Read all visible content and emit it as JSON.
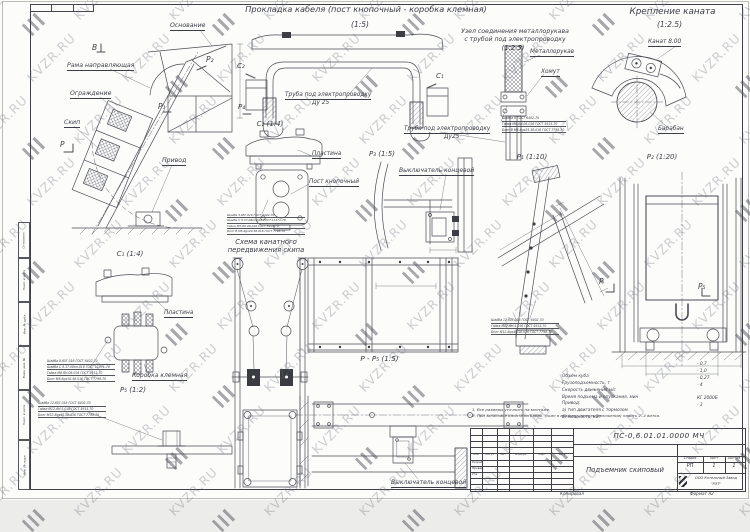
{
  "watermark": {
    "text": "KVZR.RU"
  },
  "sheet": {
    "copied": "Копировал",
    "format": "Формат А2"
  },
  "side_stamp": {
    "approved": "Согласовано",
    "boxes": [
      "Подп. и дата",
      "Инв. № дубл.",
      "Взам. инв. №",
      "Подп. и дата",
      "Инв. № подл."
    ]
  },
  "titles": {
    "cable": {
      "text": "Прокладка кабеля (пост кнопочный - коробка клемная)",
      "scale": "(1:5)"
    },
    "hose": {
      "line1": "Узел соединения металлорукава",
      "line2": "с трубой под электропроводку",
      "scale": "(1:2.5)"
    },
    "rope": {
      "text": "Крепление каната",
      "scale": "(1:2.5)"
    },
    "scheme": {
      "line1": "Схема канатного",
      "line2": "передвижения скипа"
    }
  },
  "views": {
    "c1": "С₁ (1:4)",
    "c2": "С₂ (1:4)",
    "p1": "Р₁ (1:10)",
    "p2": "Р₂ (1:20)",
    "p3": "Р₃ (1:5)",
    "p5": "Р₅ (1:2)",
    "pp5": "Р - Р₅ (1:5)"
  },
  "marks": {
    "b": "В",
    "p": "Р",
    "p1": "Р₁",
    "p2": "Р₂",
    "p4": "Р₄",
    "p5": "Р₅",
    "c1": "С₁",
    "c2": "С₂"
  },
  "labels": {
    "osnovanie": "Основание",
    "rama": "Рама направляющая",
    "ograzhdenie": "Ограждение",
    "skip": "Скип",
    "privod": "Привод",
    "truba1": "Труба под электропроводку",
    "du25_1": "Ду 25",
    "truba2": "Труба под электропроводку",
    "du25_2": "Ду25",
    "metallorukav": "Металлорукав",
    "khomut": "Хомут",
    "kanat": "Канат 8.00",
    "baraban": "Барабан",
    "plastina1": "Пластина",
    "post": "Пост кнопочный",
    "vykl1": "Выключатель концевой",
    "plastina2": "Пластина",
    "korobka": "Коробка клемная",
    "vykl2": "Выключатель концевой"
  },
  "parts": {
    "hose": [
      "Шайба 6 ГОСТ 6402-70",
      "Гайка М6-6Н.06.016 ГОСТ 5915-70",
      "Болт В М6-6gх25.58.016 ГОСТ 7798-70"
    ],
    "c2": [
      "Шайба 5.65Г.016 ГОСТ 6402-70",
      "Шайба С 5.37.08кп.016 ГОСТ 11371-78",
      "Гайка М5-6Н.06.016 ГОСТ 5915-70",
      "Болт В М5-6gх20.58.016 ГОСТ 7798-70"
    ],
    "c1": [
      "Шайба 8.65Г.016 ГОСТ 6402-70",
      "Шайба С 8.37.08кп.016 ГОСТ 11371-78",
      "Гайка М8-6Н.06.016 ГОСТ 5915-70",
      "Болт М8-6gх10.58.016 ГОСТ 7798-70"
    ],
    "p1": [
      "Шайба 12.65Г.016 ГОСТ 6402-70",
      "Гайка М12-6Н.5.016 ГОСТ 5915-70",
      "Болт М12-6gх45.58.016 ГОСТ 7798-70"
    ],
    "p5": [
      "Шайба 12.65Г.016 ГОСТ 6402-70",
      "Гайка М12-6Н.5.016 ГОСТ 5915-70",
      "Болт М12-6gх45.58.016 ГОСТ 7798-70"
    ]
  },
  "specs": {
    "rows": [
      {
        "label": "Объем куба",
        "value": "- 0,7"
      },
      {
        "label": "Грузоподъемность, т",
        "value": "- 1,0"
      },
      {
        "label": "Скорость движения м/с",
        "value": "- 0,27"
      },
      {
        "label": "Время подъема и опускания, мин",
        "value": "- 4"
      },
      {
        "label": "Привод:",
        "value": ""
      },
      {
        "label": "а) тип двигателя с тормозом",
        "value": "КГ 2000Б"
      },
      {
        "label": "б) мощность, кВт",
        "value": "- 3"
      }
    ]
  },
  "notes": [
    "1. Все размеры уточнить на монтаже.",
    "2. При запасовке каната на бараб. (скип в крайнем нижнем положении) навить 2..4 витка."
  ],
  "title_block": {
    "doc_number": "ПС-0,6.01.01.0000 МЧ",
    "name": "Подъемник скиповый",
    "stage_label": "Стадия",
    "sheet_label": "Лист",
    "sheets_label": "Листов",
    "stage": "РП",
    "sheet": "1",
    "sheets": "1",
    "company_line1": "ООО Котельный Завод",
    "company_line2": "\"РЭТ\"",
    "cols": [
      "Изм.",
      "Кол.уч",
      "Лист",
      "№ докум.",
      "Подп.",
      "Дата"
    ],
    "rows": [
      "Разраб.",
      "Провер.",
      "Утв."
    ]
  }
}
